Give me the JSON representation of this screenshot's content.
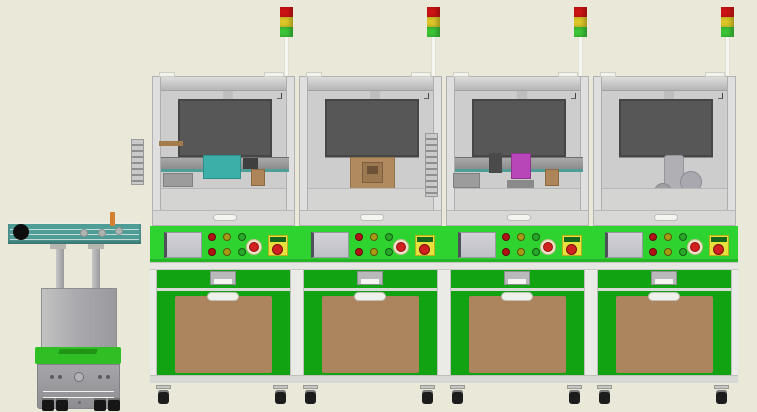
{
  "scene": {
    "kind": "cad-3d-render",
    "subject": "automated-production-line-front-view",
    "station_count": 4
  },
  "colors": {
    "bg": "#E9E8D9",
    "interior": "#CDCDCD",
    "monitor_dark": "#575757",
    "panel_green": "#2FD32F",
    "cabinet_green": "#12A312",
    "door_brown": "#AC845E",
    "fixture_brown": "#AE8558",
    "teal": "#4F9D97",
    "teal_fixture": "#3BAFA8",
    "magenta": "#B846B8",
    "estop_red": "#D22020",
    "estop_yellow": "#E8E13C",
    "estop_bar_green": "#14661A",
    "btn_red": "#B31212",
    "btn_yellow": "#A89A14",
    "btn_green": "#28A828",
    "light_red": "#CC1414",
    "light_yellow": "#DCC728",
    "light_green": "#3CC437",
    "pole_white": "#F5F5F2",
    "agv_green": "#2FBF25",
    "wheel_black": "#161616",
    "caster_black": "#1C1C1C"
  },
  "stack_light": {
    "segments": [
      "red",
      "yellow",
      "green"
    ]
  },
  "control_panel": {
    "hmi_screen": true,
    "button_rows": [
      [
        "red",
        "yellow",
        "green"
      ],
      [
        "red",
        "yellow",
        "green"
      ]
    ],
    "emergency_stop_round": true,
    "emergency_stop_box": true
  },
  "stations": [
    {
      "id": "station-1",
      "equipment": "belt-conveyor"
    },
    {
      "id": "station-2",
      "equipment": "press-fixture"
    },
    {
      "id": "station-3",
      "equipment": "pick-module"
    },
    {
      "id": "station-4",
      "equipment": "robot-arm"
    }
  ],
  "agv": {
    "rollers": 3,
    "wheels": 4,
    "conveyor_top": true
  }
}
